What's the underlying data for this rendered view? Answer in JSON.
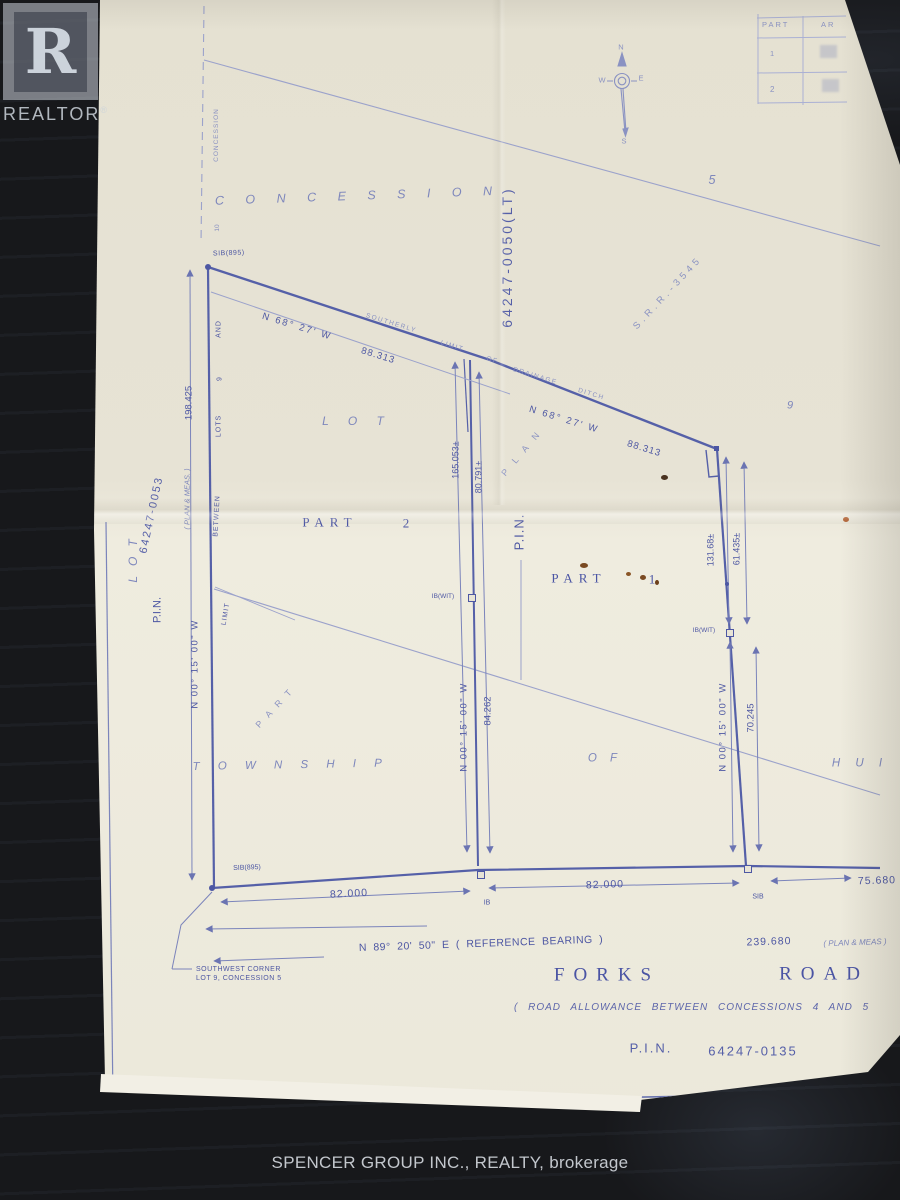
{
  "colors": {
    "ink": "#4d57a3",
    "ink_faint": "#8a92c2",
    "paper": "#e8e4d6",
    "desk": "#17181b"
  },
  "watermark": {
    "r": "R",
    "name": "REALTOR",
    "reg": "®"
  },
  "footer": {
    "brokerage": "SPENCER GROUP INC., REALTY, brokerage"
  },
  "table": {
    "h1": "PART",
    "h2": "AR",
    "r1": "1",
    "r2": "2"
  },
  "compass": {
    "n": "N",
    "e": "E",
    "s": "S",
    "w": "W"
  },
  "labels": {
    "concession_small": "CONCESSION",
    "ten": "10",
    "concession_big": "C O N C E S S I O N",
    "five": "5",
    "nine_r": "9",
    "pin_0050": "64247-0050(LT)",
    "srr": "S.R.R.-3545",
    "sib_top": "SIB(895)",
    "b1": "N 68° 27' W",
    "d1": "88.313",
    "southerly": "SOUTHERLY",
    "limit_d": "LIMIT",
    "of_d": "OF",
    "drainage": "DRAINAGE",
    "ditch": "DITCH",
    "b2": "N 68° 27' W",
    "d2": "88.313",
    "lot_big": "L O T",
    "plan_diag": "P L A N",
    "pin_mid": "P.I.N.",
    "d165": "165.053±",
    "d80": "80.791±",
    "part2": "PART",
    "part2_num": "2",
    "part1": "PART",
    "part1_num": "1",
    "ibwit_mid": "IB(WIT)",
    "ibwit_right": "IB(WIT)",
    "d131": "131.68±",
    "d61": "61.435±",
    "d198": "198.425",
    "planmeas_left": "( PLAN & MEAS. )",
    "pin_0053": "64247-0053",
    "lot_left": "LOT",
    "pin_left": "P.I.N.",
    "and_l": "AND",
    "nine_l": "9",
    "lots_l": "LOTS",
    "between_l": "BETWEEN",
    "limit_l": "LIMIT",
    "brg_left": "N 00° 15' 00\" W",
    "part_diag": "P A R T",
    "township": "T O W N S H I P",
    "of_b": "O F",
    "hu": "H U I",
    "brg_mid": "N 00° 15' 00\" W",
    "d84": "84.262",
    "brg_right": "N 00° 15' 00\" W",
    "d70": "70.245",
    "sib_bot": "SIB(895)",
    "d82a": "82.000",
    "ib_b": "IB",
    "d82b": "82.000",
    "sib_b": "SIB",
    "d75": "75.680",
    "refbrg": "N 89° 20' 50\" E  ( REFERENCE  BEARING )",
    "d239": "239.680",
    "planmeas2": "( PLAN & MEAS )",
    "swc1": "SOUTHWEST CORNER",
    "swc2": "LOT 9, CONCESSION 5",
    "forks": "FORKS",
    "road": "ROAD",
    "road_allow": "( ROAD  ALLOWANCE  BETWEEN  CONCESSIONS  4  AND  5",
    "pin_road": "P.I.N.",
    "pin_road_num": "64247-0135"
  }
}
